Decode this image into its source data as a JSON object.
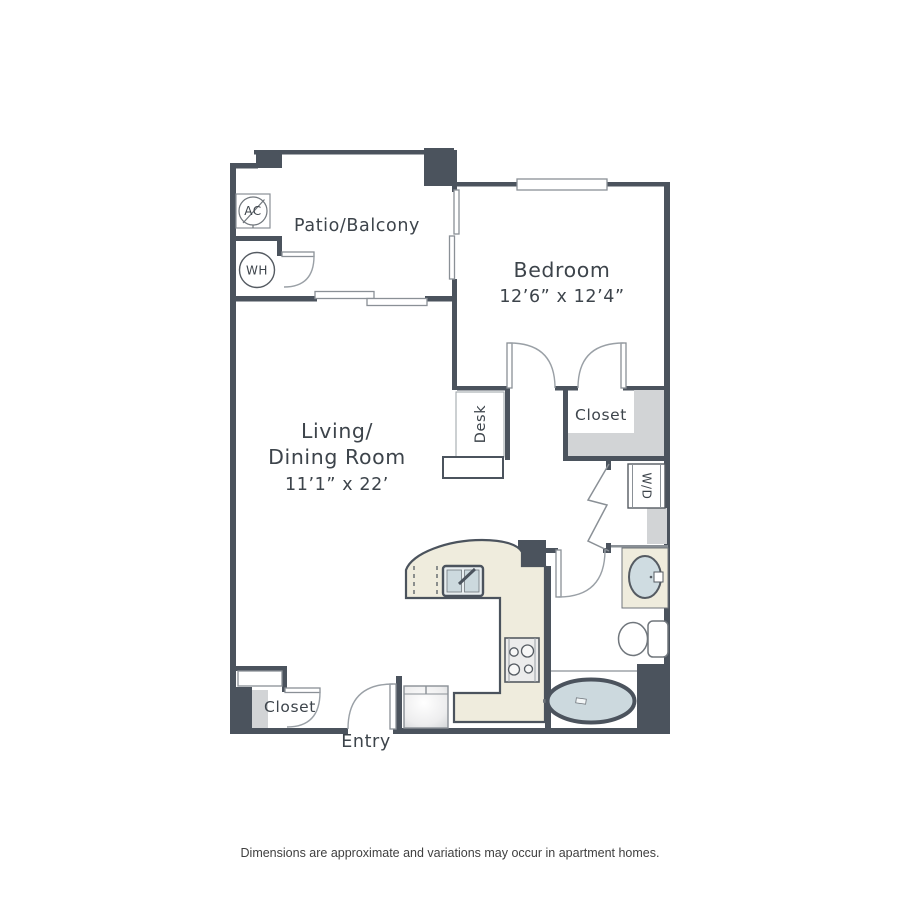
{
  "plan": {
    "rooms": {
      "patio": {
        "label": "Patio/Balcony"
      },
      "bedroom": {
        "label": "Bedroom",
        "dimensions": "12’6” x 12’4”"
      },
      "living": {
        "label_line1": "Living/",
        "label_line2": "Dining Room",
        "dimensions": "11’1” x 22’"
      },
      "bedroom_closet": {
        "label": "Closet"
      },
      "entry_closet": {
        "label": "Closet"
      },
      "entry": {
        "label": "Entry"
      },
      "desk": {
        "label": "Desk"
      },
      "washer_dryer": {
        "label": "W/D"
      },
      "ac_unit": {
        "label": "AC"
      },
      "water_heater": {
        "label": "WH"
      }
    },
    "colors": {
      "wall": "#4b535d",
      "line": "#8a9096",
      "ink": "#3d444b",
      "counter": "#efecdd",
      "fixture_gray": "#d2d4d6",
      "water": "#ccd9de"
    }
  },
  "footer": {
    "disclaimer": "Dimensions are approximate and variations may occur in apartment homes."
  }
}
